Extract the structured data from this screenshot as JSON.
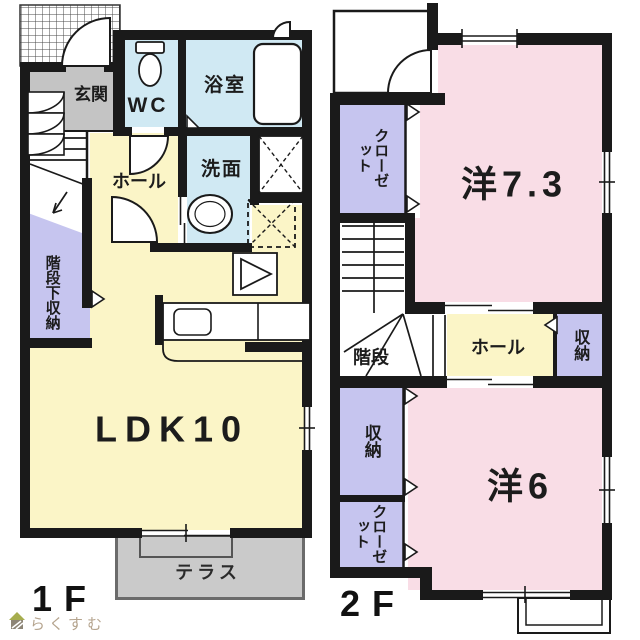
{
  "watermark": {
    "brand": "らくすむ"
  },
  "floor1": {
    "label": "1F",
    "rooms": {
      "genkan": "玄関",
      "wc": "WC",
      "bath": "浴室",
      "washroom": "洗面",
      "hall": "ホール",
      "under_stair_storage": "階段下収納",
      "ldk": "LDK10",
      "terrace": "テラス"
    }
  },
  "floor2": {
    "label": "2F",
    "rooms": {
      "closet_north": "クローゼット",
      "western_7_3": "洋7.3",
      "stairs": "階段",
      "hall": "ホール",
      "storage_east": "収納",
      "storage_west": "収納",
      "closet_south": "クローゼット",
      "western_6": "洋6"
    }
  },
  "colors": {
    "room_pink": "#f9dde6",
    "room_cream": "#fbf5c7",
    "room_blue": "#d0e9f3",
    "room_purple": "#c6c5ef",
    "genkan_gray": "#c4c4c4",
    "terrace_gray": "#cacaca",
    "wall_black": "#1a1a1a",
    "logo_tan": "#b5a48e"
  }
}
